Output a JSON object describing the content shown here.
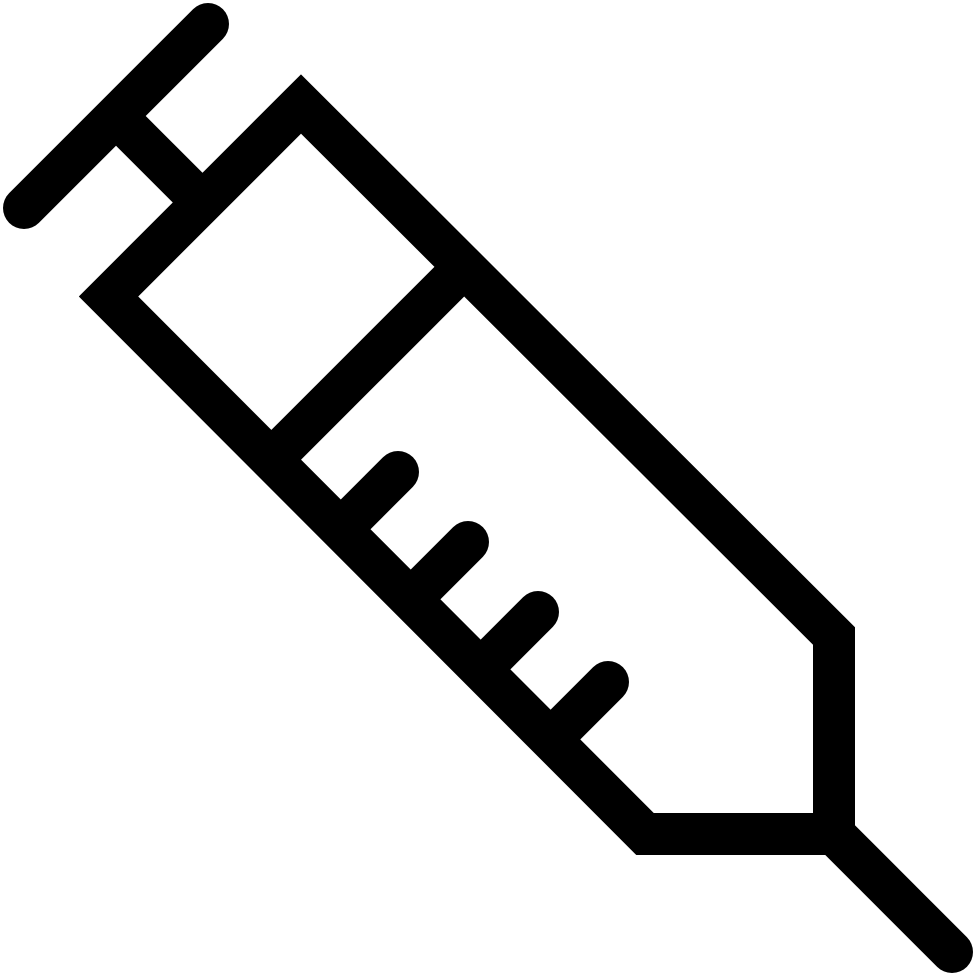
{
  "icon": {
    "name": "syringe-icon",
    "description": "syringe",
    "color": "#000000",
    "background": "#ffffff",
    "stroke_width": 42,
    "canvas": {
      "width": 980,
      "height": 980
    },
    "elements": [
      {
        "type": "line",
        "name": "plunger-handle",
        "x1": 24,
        "y1": 208,
        "x2": 208,
        "y2": 24,
        "cap": "round"
      },
      {
        "type": "line",
        "name": "plunger-rod",
        "x1": 112,
        "y1": 112,
        "x2": 208,
        "y2": 208,
        "cap": "butt"
      },
      {
        "type": "polygon",
        "name": "barrel-outline",
        "join": "miter",
        "points": [
          [
            301,
            104
          ],
          [
            108.5,
            296.5
          ],
          [
            645,
            834
          ],
          [
            834,
            834
          ],
          [
            834,
            636
          ]
        ]
      },
      {
        "type": "line",
        "name": "barrel-divider",
        "x1": 262,
        "y1": 469,
        "x2": 474,
        "y2": 257,
        "cap": "butt"
      },
      {
        "type": "line",
        "name": "scale-tick-1",
        "x1": 341,
        "y1": 529,
        "x2": 398,
        "y2": 472,
        "cap": "round"
      },
      {
        "type": "line",
        "name": "scale-tick-2",
        "x1": 411,
        "y1": 599,
        "x2": 468,
        "y2": 542,
        "cap": "round"
      },
      {
        "type": "line",
        "name": "scale-tick-3",
        "x1": 481,
        "y1": 669,
        "x2": 538,
        "y2": 612,
        "cap": "round"
      },
      {
        "type": "line",
        "name": "scale-tick-4",
        "x1": 551,
        "y1": 739,
        "x2": 608,
        "y2": 682,
        "cap": "round"
      },
      {
        "type": "line",
        "name": "needle",
        "x1": 834,
        "y1": 834,
        "x2": 952,
        "y2": 952,
        "cap": "round"
      }
    ]
  }
}
